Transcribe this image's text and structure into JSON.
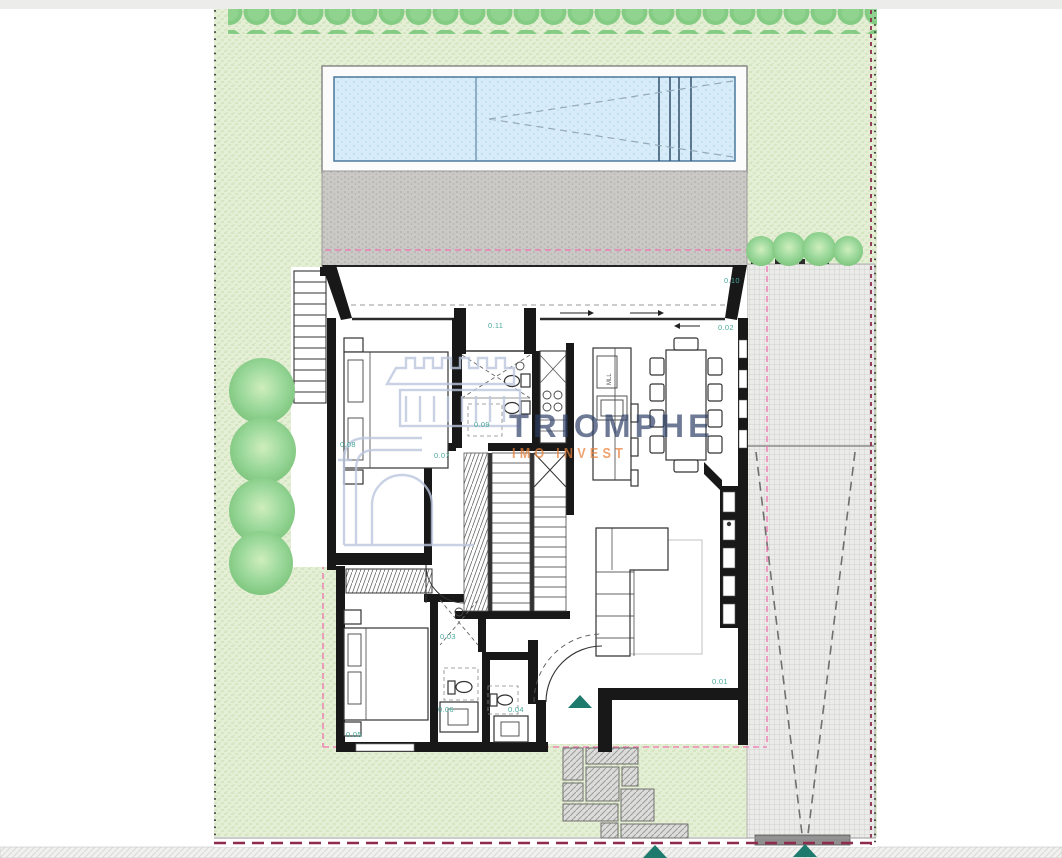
{
  "page": {
    "type": "architectural site plan - villa ground floor with garden, pool and driveway",
    "background": "#ffffff"
  },
  "watermark": {
    "brand": "TRIOMPHE",
    "tagline": "IMO INVEST",
    "brand_color": "#2e3f66",
    "tagline_color": "#e8823a"
  },
  "plan": {
    "room_labels": [
      {
        "number": "0.01"
      },
      {
        "number": "0.02"
      },
      {
        "number": "0.03"
      },
      {
        "number": "0.04"
      },
      {
        "number": "0.05"
      },
      {
        "number": "0.06"
      },
      {
        "number": "0.07"
      },
      {
        "number": "0.08"
      },
      {
        "number": "0.09"
      },
      {
        "number": "0.10"
      },
      {
        "number": "0.11"
      }
    ],
    "kitchen_island_label": "MLL",
    "colors": {
      "lawn": "#e4efd5",
      "pool_water": "#d7ecf8",
      "deck": "#cbc9c6",
      "driveway": "#ebebe9",
      "label_teal": "#4aa99c",
      "entry_marker_teal": "#1d7a6d",
      "setback_pink": "#ef72ae",
      "boundary_dark_red": "#8f2b4e",
      "hedge_green": "#84cb84",
      "wall_black": "#181818"
    }
  }
}
